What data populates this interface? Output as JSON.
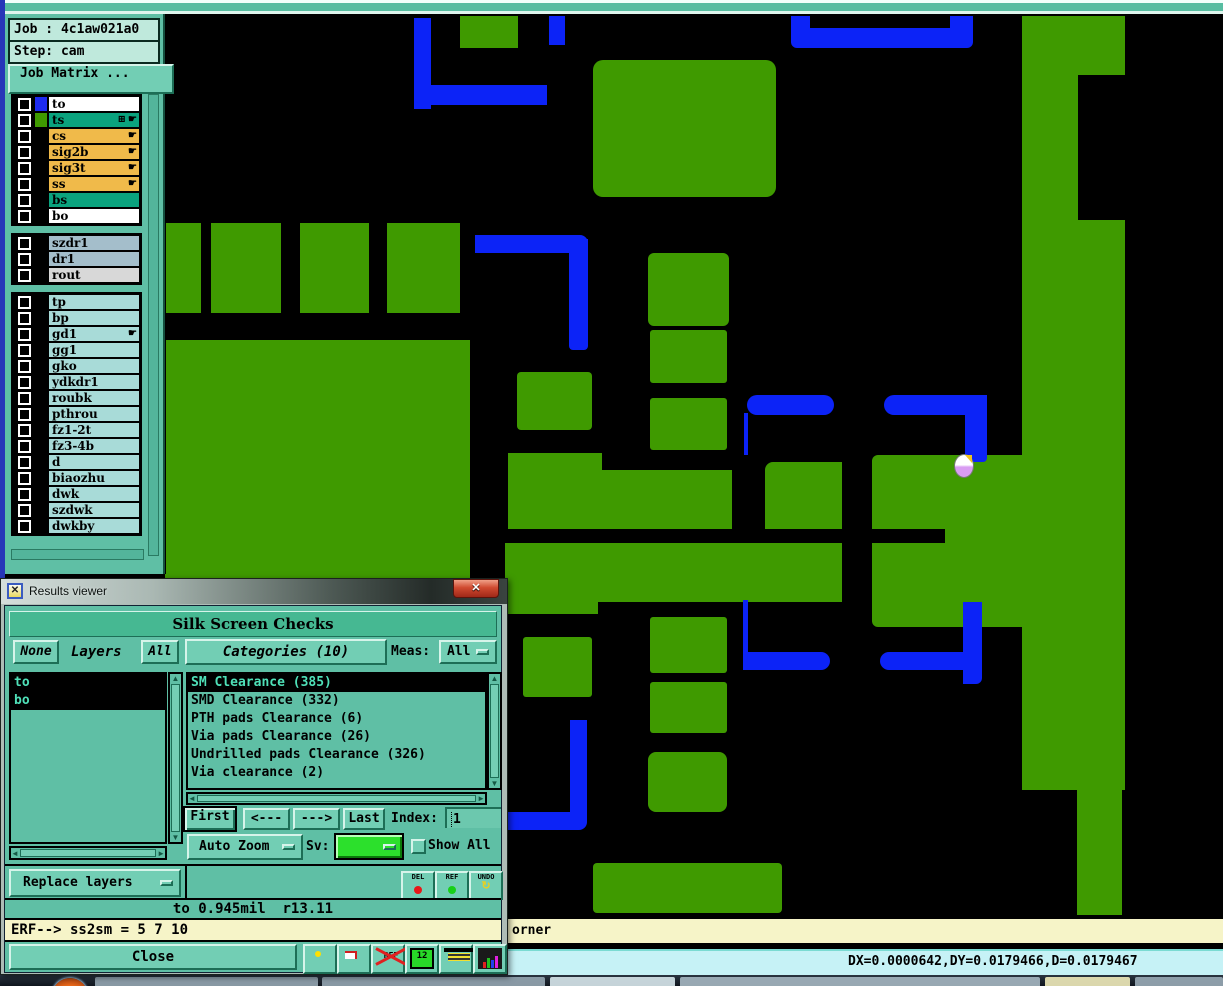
{
  "colors": {
    "pcb_green": "#3f9a00",
    "pcb_blue": "#0c23f7",
    "panel_teal": "#5fbfa5",
    "selected_green": "#2ce02c",
    "row_orange": "#f0ba4a",
    "row_teal": "#0aa37e",
    "row_cyan": "#a8dbd8",
    "row_grayblue": "#a4becb",
    "row_gray": "#d8d8d8"
  },
  "icons": {
    "pointer": "☛",
    "grid": "⊞",
    "undo_arrow": "↺",
    "title_glyph": "✕",
    "close_glyph": "✕",
    "scroll_up": "▲",
    "scroll_down": "▼",
    "scroll_left": "◄",
    "scroll_right": "►"
  },
  "sidebar": {
    "job_label": "Job : 4c1aw021a0",
    "step_label": "Step: cam",
    "job_matrix_button": "Job Matrix ...",
    "layer_groups": [
      {
        "rows": [
          {
            "name": "to",
            "bg": "#ffffff",
            "swatch": "#1e2cf0"
          },
          {
            "name": "ts",
            "bg": "#0aa37e",
            "swatch": "#3f9a00",
            "icons": [
              "pointer",
              "grid"
            ]
          },
          {
            "name": "cs",
            "bg": "#f0ba4a",
            "swatch": "#000000",
            "icons": [
              "pointer"
            ]
          },
          {
            "name": "sig2b",
            "bg": "#f0ba4a",
            "swatch": "#000000",
            "icons": [
              "pointer"
            ]
          },
          {
            "name": "sig3t",
            "bg": "#f0ba4a",
            "swatch": "#000000",
            "icons": [
              "pointer"
            ]
          },
          {
            "name": "ss",
            "bg": "#f0ba4a",
            "swatch": "#000000",
            "icons": [
              "pointer"
            ]
          },
          {
            "name": "bs",
            "bg": "#0aa37e",
            "swatch": "#000000"
          },
          {
            "name": "bo",
            "bg": "#ffffff",
            "swatch": "#000000"
          }
        ]
      },
      {
        "rows": [
          {
            "name": "szdr1",
            "bg": "#a4becb",
            "swatch": "#000000"
          },
          {
            "name": "dr1",
            "bg": "#a4becb",
            "swatch": "#000000"
          },
          {
            "name": "rout",
            "bg": "#d8d8d8",
            "swatch": "#000000"
          }
        ]
      },
      {
        "rows": [
          {
            "name": "tp",
            "bg": "#a8dbd8",
            "swatch": "#000000"
          },
          {
            "name": "bp",
            "bg": "#a8dbd8",
            "swatch": "#000000"
          },
          {
            "name": "gd1",
            "bg": "#a8dbd8",
            "swatch": "#000000",
            "icons": [
              "pointer"
            ]
          },
          {
            "name": "gg1",
            "bg": "#a8dbd8",
            "swatch": "#000000"
          },
          {
            "name": "gko",
            "bg": "#a8dbd8",
            "swatch": "#000000"
          },
          {
            "name": "ydkdr1",
            "bg": "#a8dbd8",
            "swatch": "#000000"
          },
          {
            "name": "roubk",
            "bg": "#a8dbd8",
            "swatch": "#000000"
          },
          {
            "name": "pthrou",
            "bg": "#a8dbd8",
            "swatch": "#000000"
          },
          {
            "name": "fz1-2t",
            "bg": "#a8dbd8",
            "swatch": "#000000"
          },
          {
            "name": "fz3-4b",
            "bg": "#a8dbd8",
            "swatch": "#000000"
          },
          {
            "name": "d",
            "bg": "#a8dbd8",
            "swatch": "#000000"
          },
          {
            "name": "biaozhu",
            "bg": "#a8dbd8",
            "swatch": "#000000"
          },
          {
            "name": "dwk",
            "bg": "#a8dbd8",
            "swatch": "#000000"
          },
          {
            "name": "szdwk",
            "bg": "#a8dbd8",
            "swatch": "#000000"
          },
          {
            "name": "dwkby",
            "bg": "#a8dbd8",
            "swatch": "#000000"
          }
        ]
      }
    ]
  },
  "dialog": {
    "title": "Results viewer",
    "header": "Silk Screen Checks",
    "none_button": "None",
    "layers_label": "Layers",
    "all_button": "All",
    "categories_button": "Categories (10)",
    "meas_label": "Meas:",
    "meas_value": "All",
    "layers_list": [
      "to",
      "bo"
    ],
    "categories": [
      {
        "label": "SM Clearance (385)",
        "selected": true
      },
      {
        "label": "SMD Clearance (332)",
        "selected": false
      },
      {
        "label": "PTH pads Clearance (6)",
        "selected": false
      },
      {
        "label": "Via pads Clearance (26)",
        "selected": false
      },
      {
        "label": "Undrilled pads Clearance (326)",
        "selected": false
      },
      {
        "label": "Via clearance (2)",
        "selected": false
      }
    ],
    "first_button": "First",
    "prev_button": "<---",
    "next_button": "--->",
    "last_button": "Last",
    "index_label": "Index:",
    "index_value": "1",
    "auto_zoom_button": "Auto Zoom",
    "sv_label": "Sv:",
    "show_all_label": "Show All",
    "replace_layers_button": "Replace layers",
    "del_button": "DEL",
    "ref_button": "REF",
    "undo_button": "UNDO",
    "status_text": "to 0.945mil  r13.11",
    "erf_text": "ERF--> ss2sm = 5 7 10",
    "close_button": "Close",
    "ref_crossed_icon_label": "REF",
    "pages_icon_label": "12"
  },
  "status_bars": {
    "yellow_text": "orner",
    "cyan_text": "DX=0.0000642,DY=0.0179466,D=0.0179467"
  },
  "taskbar": {
    "items": [
      {
        "x": 95,
        "w": 223,
        "c": "#8fa0ac"
      },
      {
        "x": 322,
        "w": 223,
        "c": "#8fa0ac"
      },
      {
        "x": 550,
        "w": 125,
        "c": "#cfdde3"
      },
      {
        "x": 680,
        "w": 360,
        "c": "#9fb0ba"
      },
      {
        "x": 1045,
        "w": 85,
        "c": "#e6e2b4"
      },
      {
        "x": 1135,
        "w": 88,
        "c": "#93a4b0"
      }
    ]
  },
  "canvas": {
    "shapes": [
      {
        "c": "g",
        "x": 460,
        "y": 2,
        "w": 58,
        "h": 32,
        "r": ""
      },
      {
        "c": "g",
        "x": 593,
        "y": 46,
        "w": 183,
        "h": 137,
        "r": "10px"
      },
      {
        "c": "g",
        "x": 163,
        "y": 209,
        "w": 38,
        "h": 90,
        "r": ""
      },
      {
        "c": "g",
        "x": 211,
        "y": 209,
        "w": 70,
        "h": 90,
        "r": ""
      },
      {
        "c": "g",
        "x": 300,
        "y": 209,
        "w": 69,
        "h": 90,
        "r": ""
      },
      {
        "c": "g",
        "x": 387,
        "y": 209,
        "w": 73,
        "h": 90,
        "r": ""
      },
      {
        "c": "g",
        "x": 165,
        "y": 326,
        "w": 305,
        "h": 256,
        "r": ""
      },
      {
        "c": "g",
        "x": 517,
        "y": 358,
        "w": 75,
        "h": 58,
        "r": "4px"
      },
      {
        "c": "g",
        "x": 648,
        "y": 239,
        "w": 81,
        "h": 73,
        "r": "6px"
      },
      {
        "c": "g",
        "x": 650,
        "y": 316,
        "w": 77,
        "h": 53,
        "r": "3px"
      },
      {
        "c": "g",
        "x": 650,
        "y": 384,
        "w": 77,
        "h": 52,
        "r": "3px"
      },
      {
        "c": "g",
        "x": 508,
        "y": 439,
        "w": 94,
        "h": 76,
        "r": ""
      },
      {
        "c": "g",
        "x": 602,
        "y": 456,
        "w": 130,
        "h": 59,
        "r": ""
      },
      {
        "c": "g",
        "x": 765,
        "y": 448,
        "w": 77,
        "h": 67,
        "r": "8px 0 0 0"
      },
      {
        "c": "g",
        "x": 505,
        "y": 529,
        "w": 337,
        "h": 59,
        "r": ""
      },
      {
        "c": "g",
        "x": 505,
        "y": 586,
        "w": 93,
        "h": 14,
        "r": ""
      },
      {
        "c": "g",
        "x": 872,
        "y": 441,
        "w": 150,
        "h": 74,
        "r": "6px 0 0 0"
      },
      {
        "c": "g",
        "x": 945,
        "y": 513,
        "w": 77,
        "h": 18,
        "r": ""
      },
      {
        "c": "g",
        "x": 872,
        "y": 529,
        "w": 150,
        "h": 84,
        "r": "0 0 0 6px"
      },
      {
        "c": "g",
        "x": 1022,
        "y": 2,
        "w": 56,
        "h": 774,
        "r": ""
      },
      {
        "c": "g",
        "x": 1078,
        "y": 2,
        "w": 47,
        "h": 59,
        "r": ""
      },
      {
        "c": "g",
        "x": 1078,
        "y": 206,
        "w": 47,
        "h": 570,
        "r": ""
      },
      {
        "c": "g",
        "x": 1077,
        "y": 774,
        "w": 45,
        "h": 127,
        "r": ""
      },
      {
        "c": "g",
        "x": 523,
        "y": 623,
        "w": 69,
        "h": 60,
        "r": "3px"
      },
      {
        "c": "g",
        "x": 650,
        "y": 603,
        "w": 77,
        "h": 56,
        "r": "3px"
      },
      {
        "c": "g",
        "x": 650,
        "y": 668,
        "w": 77,
        "h": 51,
        "r": "3px"
      },
      {
        "c": "g",
        "x": 648,
        "y": 738,
        "w": 79,
        "h": 60,
        "r": "8px"
      },
      {
        "c": "g",
        "x": 593,
        "y": 849,
        "w": 189,
        "h": 50,
        "r": "4px"
      },
      {
        "c": "b",
        "x": 414,
        "y": 4,
        "w": 17,
        "h": 91,
        "r": ""
      },
      {
        "c": "b",
        "x": 414,
        "y": 71,
        "w": 133,
        "h": 20,
        "r": "0 0 0 10px"
      },
      {
        "c": "b",
        "x": 549,
        "y": 2,
        "w": 16,
        "h": 29,
        "r": ""
      },
      {
        "c": "b",
        "x": 791,
        "y": 14,
        "w": 182,
        "h": 20,
        "r": "0 0 6px 6px"
      },
      {
        "c": "b",
        "x": 791,
        "y": 2,
        "w": 19,
        "h": 18,
        "r": ""
      },
      {
        "c": "b",
        "x": 950,
        "y": 2,
        "w": 23,
        "h": 24,
        "r": ""
      },
      {
        "c": "b",
        "x": 475,
        "y": 221,
        "w": 113,
        "h": 18,
        "r": "0 8px 0 0"
      },
      {
        "c": "b",
        "x": 569,
        "y": 225,
        "w": 19,
        "h": 111,
        "r": "0 0 4px 4px"
      },
      {
        "c": "b",
        "x": 747,
        "y": 381,
        "w": 87,
        "h": 20,
        "r": "10px"
      },
      {
        "c": "b",
        "x": 744,
        "y": 399,
        "w": 4,
        "h": 42,
        "r": ""
      },
      {
        "c": "b",
        "x": 884,
        "y": 381,
        "w": 103,
        "h": 20,
        "r": "10px 0 0 10px"
      },
      {
        "c": "b",
        "x": 965,
        "y": 393,
        "w": 22,
        "h": 55,
        "r": "0 0 4px 4px"
      },
      {
        "c": "b",
        "x": 743,
        "y": 586,
        "w": 5,
        "h": 54,
        "r": ""
      },
      {
        "c": "b",
        "x": 743,
        "y": 638,
        "w": 87,
        "h": 18,
        "r": "0 9px 9px 0"
      },
      {
        "c": "b",
        "x": 880,
        "y": 638,
        "w": 102,
        "h": 18,
        "r": "9px 0 0 9px"
      },
      {
        "c": "b",
        "x": 963,
        "y": 588,
        "w": 19,
        "h": 82,
        "r": "0 0 6px 0"
      },
      {
        "c": "b",
        "x": 570,
        "y": 706,
        "w": 17,
        "h": 102,
        "r": ""
      },
      {
        "c": "b",
        "x": 508,
        "y": 798,
        "w": 79,
        "h": 18,
        "r": "0 0 8px 0"
      }
    ]
  }
}
